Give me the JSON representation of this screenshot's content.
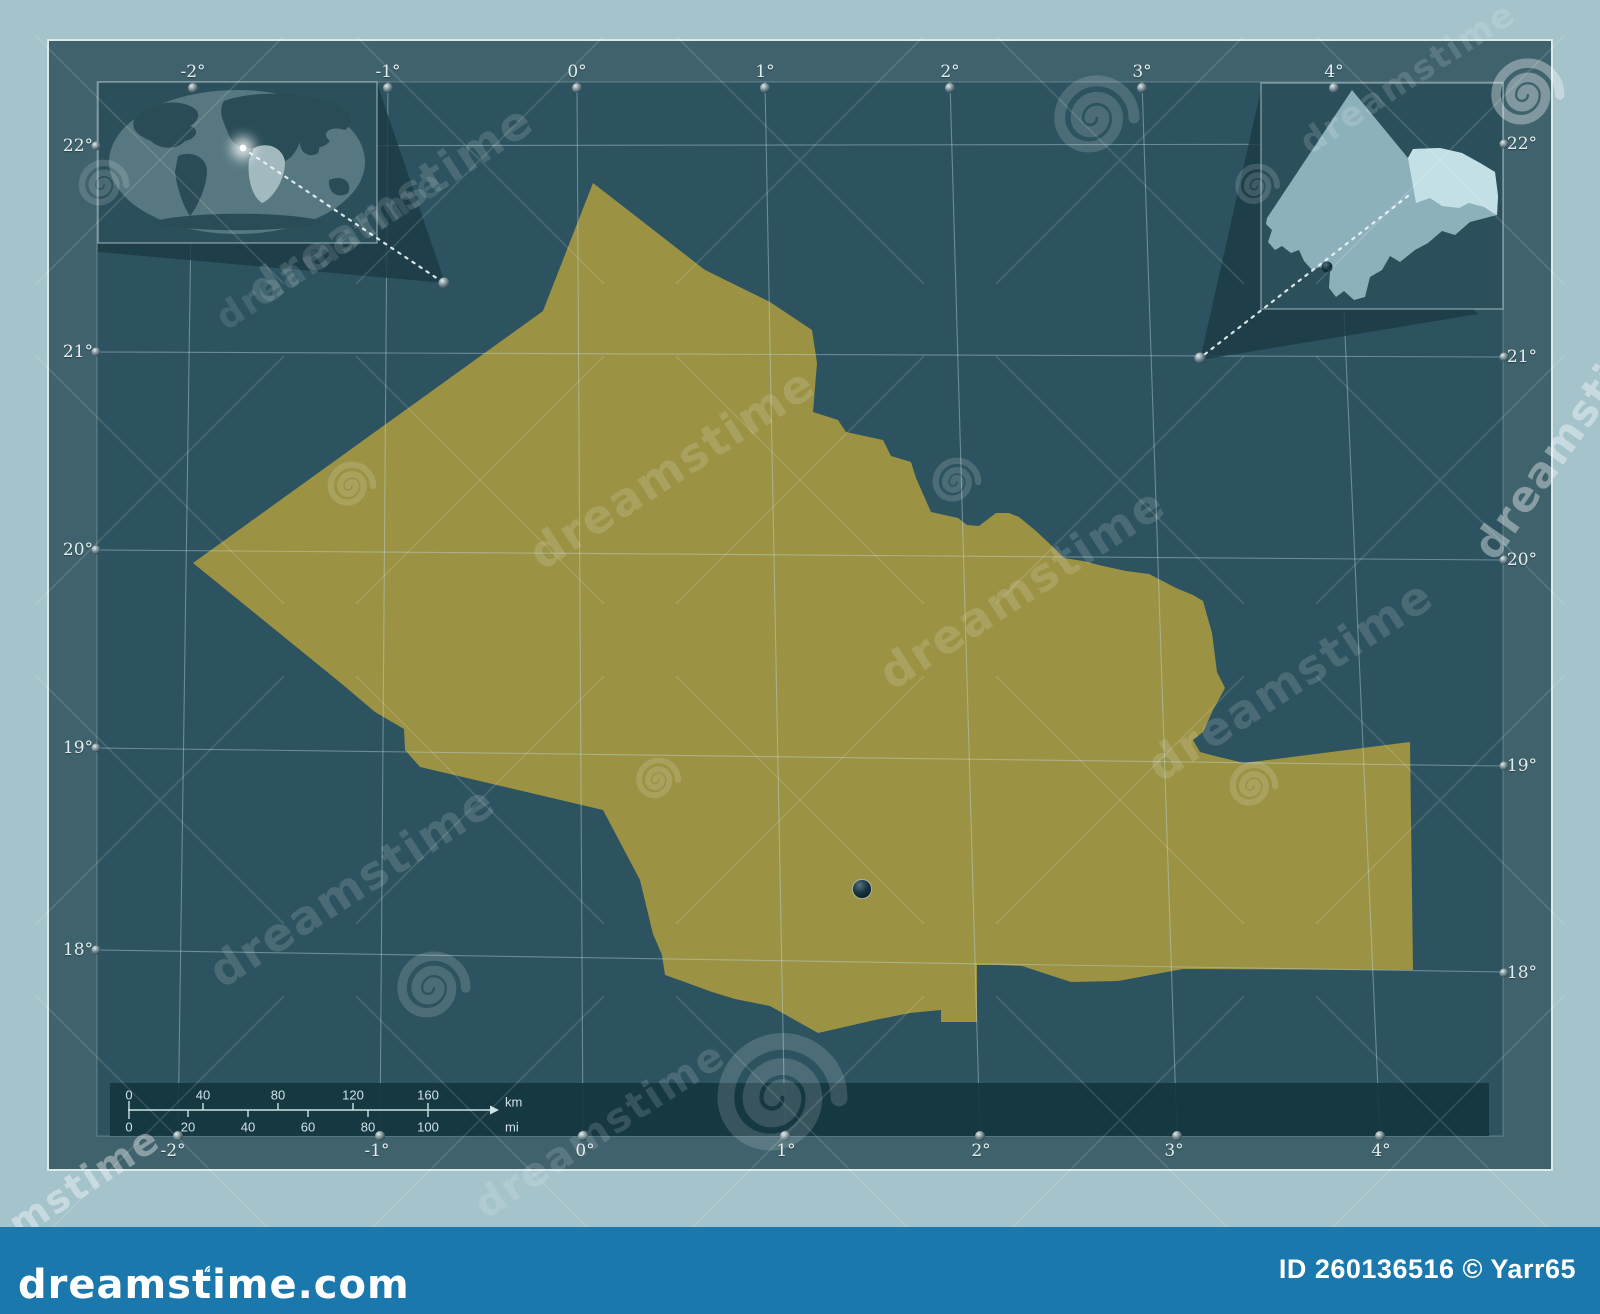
{
  "axes": {
    "top": [
      "-2°",
      "-1°",
      "0°",
      "1°",
      "2°",
      "3°",
      "4°"
    ],
    "bottom": [
      "-2°",
      "-1°",
      "0°",
      "1°",
      "2°",
      "3°",
      "4°"
    ],
    "left": [
      "22°",
      "21°",
      "20°",
      "19°",
      "18°"
    ],
    "right": [
      "22°",
      "21°",
      "20°",
      "19°",
      "18°"
    ]
  },
  "scalebar": {
    "km": [
      "0",
      "40",
      "80",
      "120",
      "160"
    ],
    "mi": [
      "0",
      "20",
      "40",
      "60",
      "80",
      "100"
    ],
    "km_unit": "km",
    "mi_unit": "mi"
  },
  "watermark": {
    "brand": "dreamstime",
    "site": "dreamstime.com"
  },
  "footer": {
    "credit": "ID 260136516 © Yarr65"
  },
  "colors": {
    "page_bg": "#a5c3cb",
    "frame": "#3f626d",
    "map_bg": "#2d5360",
    "region": "#9b9244",
    "inset_country": "#8db1bb",
    "inset_highlight": "#c3e0e7",
    "footer_bar": "#1b78ac"
  }
}
